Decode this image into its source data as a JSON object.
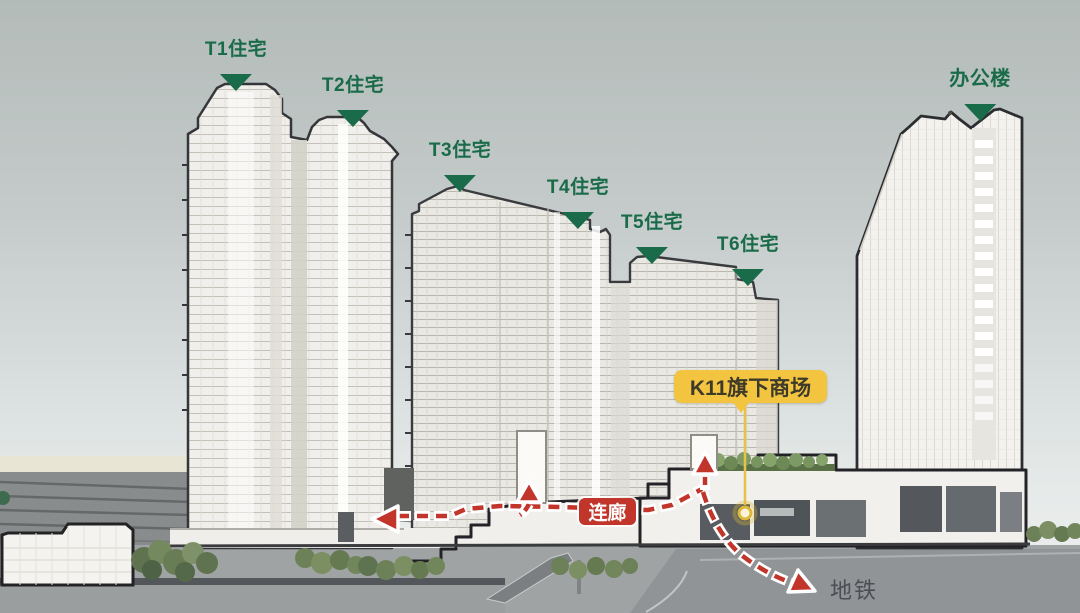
{
  "diagram": {
    "towers": [
      {
        "id": "t1",
        "label": "T1住宅"
      },
      {
        "id": "t2",
        "label": "T2住宅"
      },
      {
        "id": "t3",
        "label": "T3住宅"
      },
      {
        "id": "t4",
        "label": "T4住宅"
      },
      {
        "id": "t5",
        "label": "T5住宅"
      },
      {
        "id": "t6",
        "label": "T6住宅"
      },
      {
        "id": "office",
        "label": "办公楼"
      }
    ],
    "mall_badge": "K11旗下商场",
    "corridor_badge": "连廊",
    "subway_label": "地铁",
    "colors": {
      "label_green": "#1a6b49",
      "badge_yellow": "#f2c440",
      "badge_text": "#3d3a2a",
      "route_red": "#c2352b",
      "marker_yellow": "#dcb73a",
      "subway_text": "#4b4e53"
    }
  }
}
